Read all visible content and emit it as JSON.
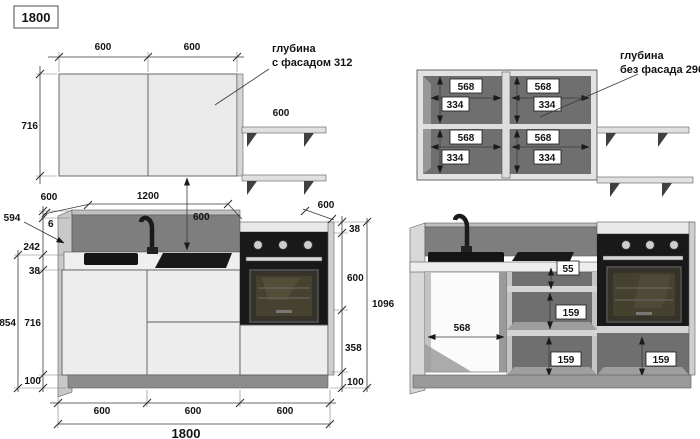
{
  "header": {
    "size_label": "1800"
  },
  "wall_facade_view": {
    "door_width_dims": [
      "600",
      "600"
    ],
    "height_dim": "716",
    "shelf_width_dim": "600",
    "depth_note_line1": "глубина",
    "depth_note_line2": "с фасадом 312"
  },
  "wall_open_view": {
    "depth_note_line1": "глубина",
    "depth_note_line2": "без фасада 296",
    "cells": [
      {
        "width_dim": "568",
        "height_dim": "334"
      },
      {
        "width_dim": "568",
        "height_dim": "334"
      },
      {
        "width_dim": "568",
        "height_dim": "334"
      },
      {
        "width_dim": "568",
        "height_dim": "334"
      }
    ]
  },
  "base_facade_view": {
    "top_dims": {
      "left_width": "600",
      "span": "1200",
      "gap_to_counter": "600",
      "oven_width": "600"
    },
    "left_dims": {
      "backsplash_leader": "594",
      "top_edge": "6",
      "backsplash_height": "242",
      "counter_thickness": "38",
      "cabinet_height": "716",
      "plinth_height": "100",
      "total_height": "854"
    },
    "right_dims": {
      "counter_thickness": "38",
      "oven_height": "600",
      "lower_height": "358",
      "plinth_height": "100",
      "total_height": "1096"
    },
    "bottom_dims": {
      "columns": [
        "600",
        "600",
        "600"
      ],
      "total_width": "1800"
    }
  },
  "base_open_view": {
    "sink_cabinet_width": "568",
    "top_drawer_gap": "55",
    "middle_drawer_heights": [
      "159",
      "159"
    ],
    "oven_drawer_height": "159"
  }
}
